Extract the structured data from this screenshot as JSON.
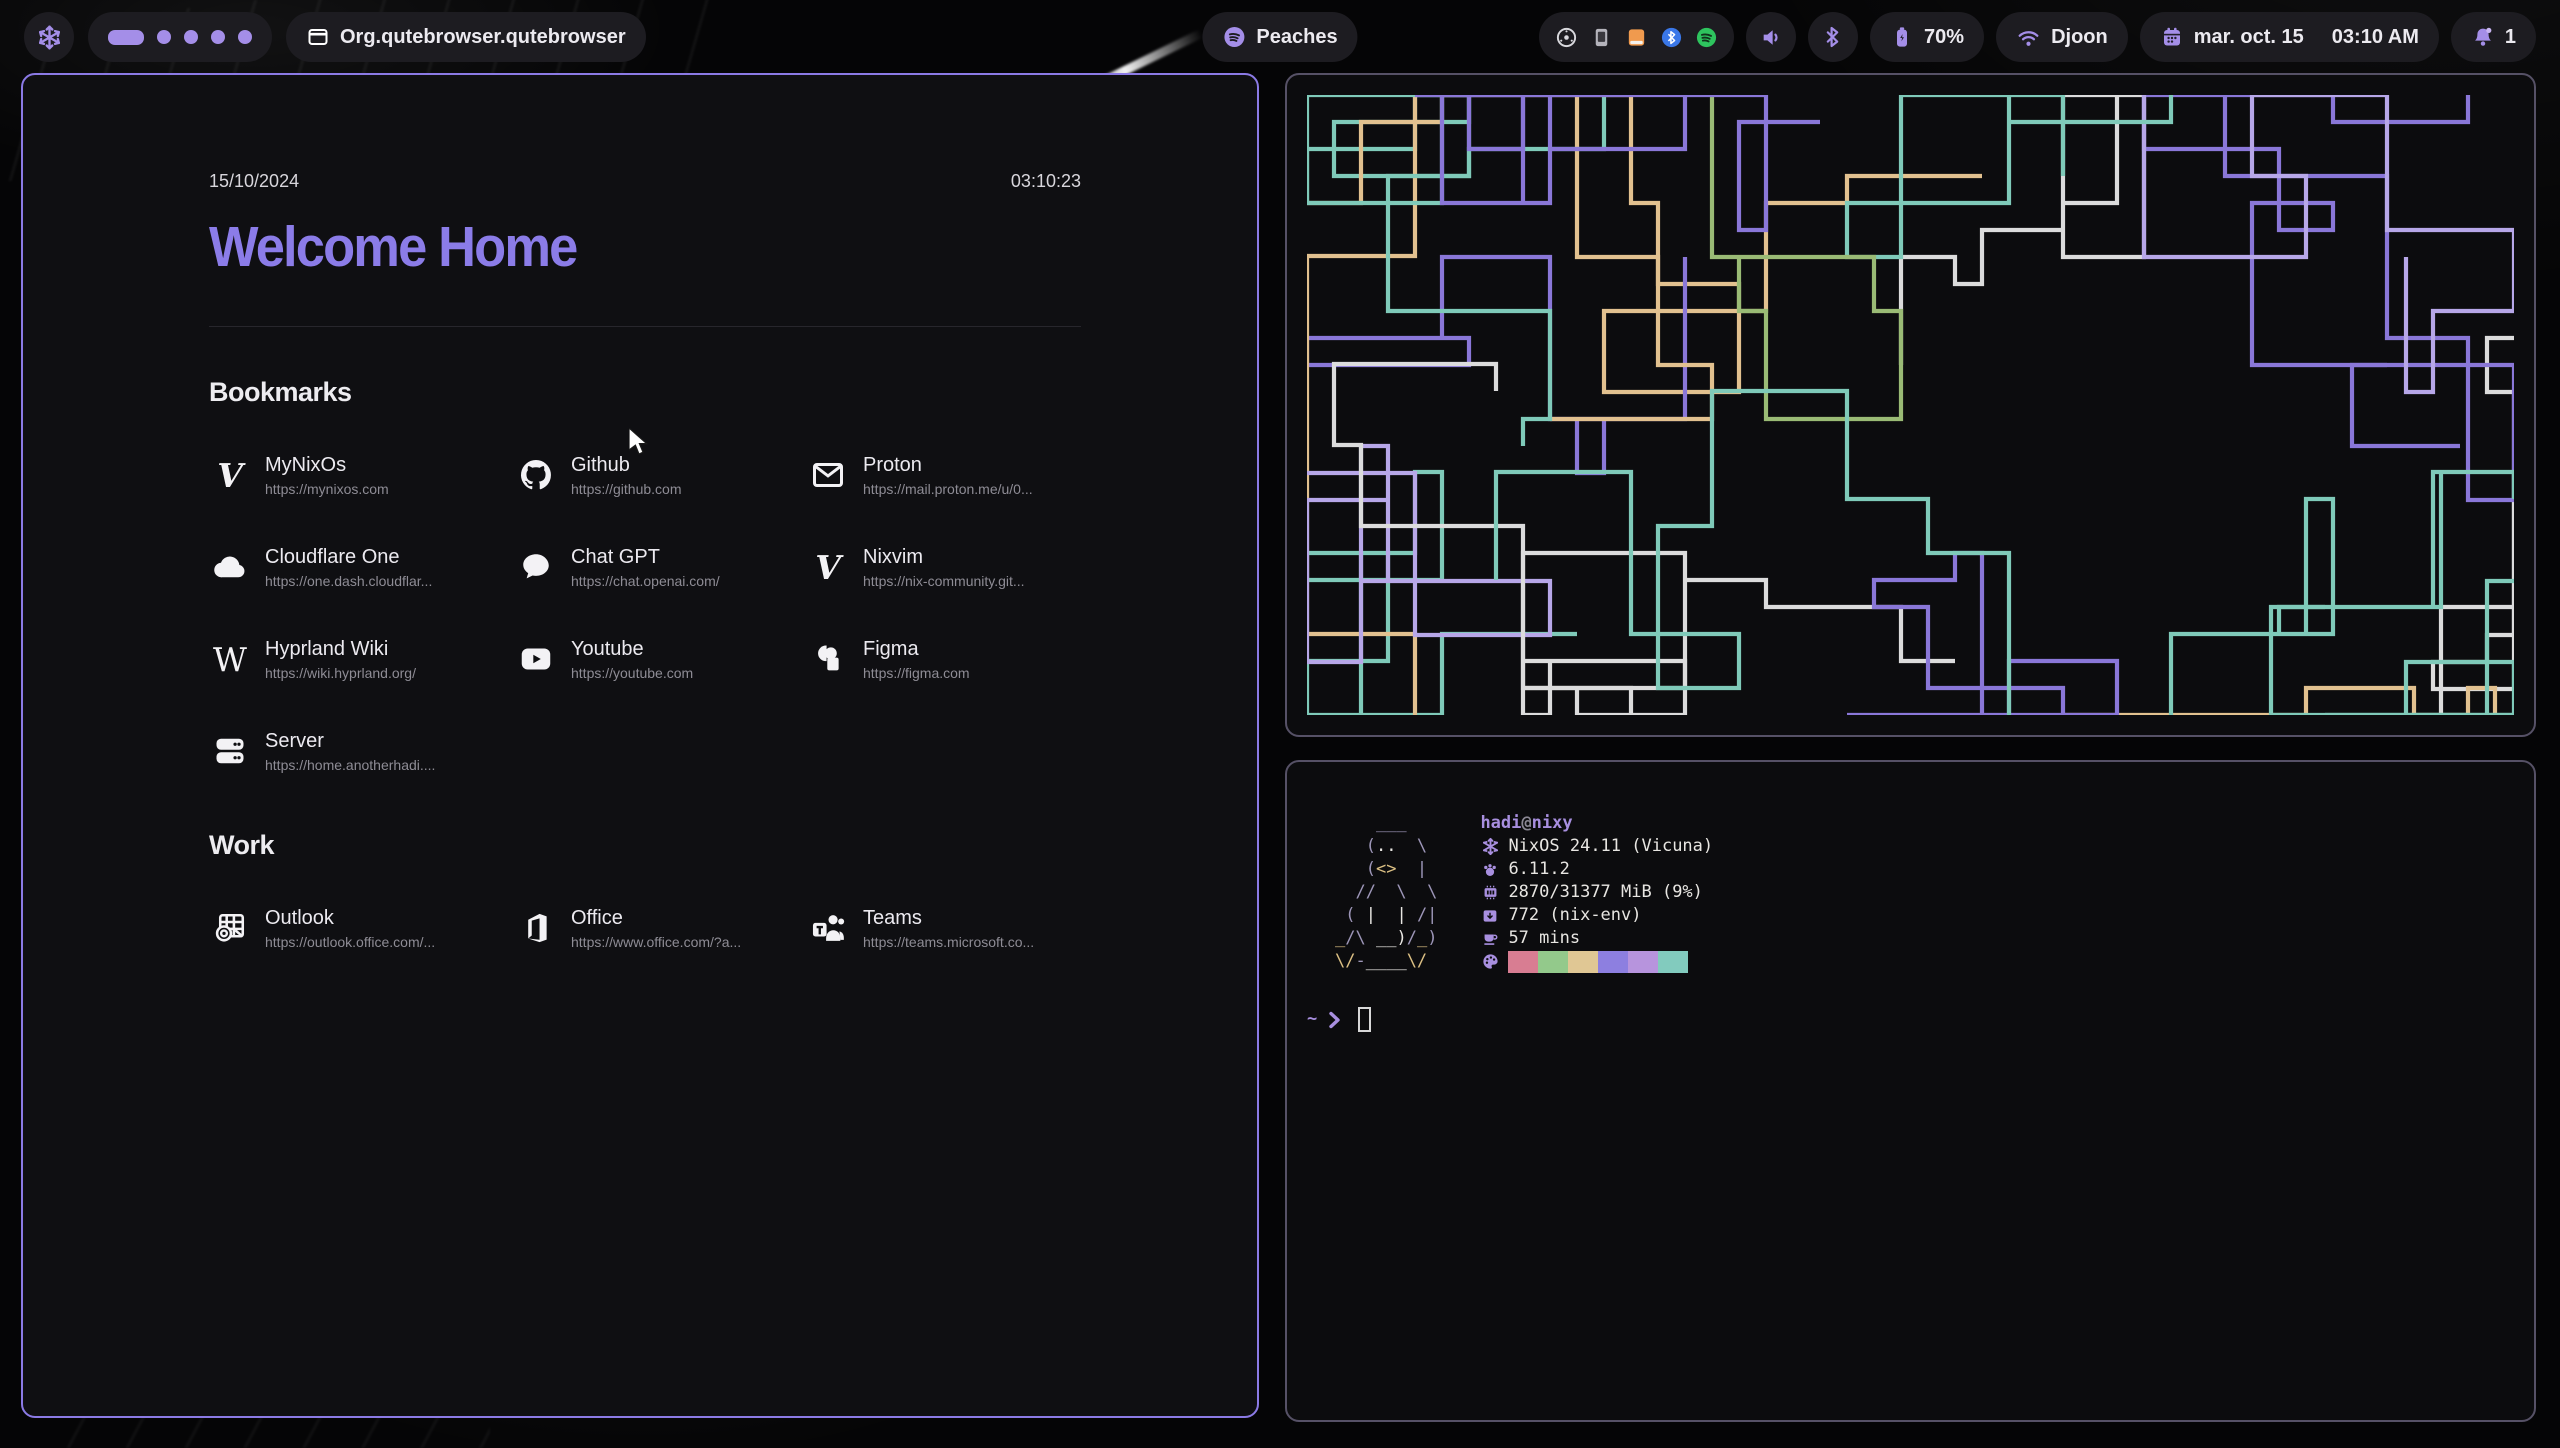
{
  "topbar": {
    "logo": "nix-snowflake-icon",
    "workspaces": {
      "total": 5,
      "active_index": 0
    },
    "window_title": "Org.qutebrowser.qutebrowser",
    "now_playing": "Peaches",
    "battery": "70%",
    "network": "Djoon",
    "date_label": "mar. oct. 15",
    "time_label": "03:10 AM",
    "notifications": "1"
  },
  "startpage": {
    "date": "15/10/2024",
    "time": "03:10:23",
    "title": "Welcome Home",
    "sections": [
      {
        "title": "Bookmarks",
        "items": [
          {
            "name": "MyNixOs",
            "url": "https://mynixos.com",
            "icon": "nix-snowflake-icon"
          },
          {
            "name": "Github",
            "url": "https://github.com",
            "icon": "github-icon"
          },
          {
            "name": "Proton",
            "url": "https://mail.proton.me/u/0...",
            "icon": "mail-icon"
          },
          {
            "name": "Cloudflare One",
            "url": "https://one.dash.cloudflar...",
            "icon": "cloud-icon"
          },
          {
            "name": "Chat GPT",
            "url": "https://chat.openai.com/",
            "icon": "chat-bubble-icon"
          },
          {
            "name": "Nixvim",
            "url": "https://nix-community.git...",
            "icon": "letter-v-icon"
          },
          {
            "name": "Hyprland Wiki",
            "url": "https://wiki.hyprland.org/",
            "icon": "wikipedia-icon"
          },
          {
            "name": "Youtube",
            "url": "https://youtube.com",
            "icon": "youtube-icon"
          },
          {
            "name": "Figma",
            "url": "https://figma.com",
            "icon": "figma-icon"
          },
          {
            "name": "Server",
            "url": "https://home.anotherhadi....",
            "icon": "server-icon"
          }
        ]
      },
      {
        "title": "Work",
        "items": [
          {
            "name": "Outlook",
            "url": "https://outlook.office.com/...",
            "icon": "outlook-icon"
          },
          {
            "name": "Office",
            "url": "https://www.office.com/?a...",
            "icon": "office-icon"
          },
          {
            "name": "Teams",
            "url": "https://teams.microsoft.co...",
            "icon": "teams-icon"
          }
        ]
      }
    ]
  },
  "fastfetch": {
    "user": "hadi",
    "at": "@",
    "host": "nixy",
    "rows": [
      {
        "icon": "nixos-icon",
        "text": "NixOS 24.11 (Vicuna)"
      },
      {
        "icon": "kernel-icon",
        "text": "6.11.2"
      },
      {
        "icon": "memory-icon",
        "text": "2870/31377 MiB (9%)"
      },
      {
        "icon": "packages-icon",
        "text": "772 (nix-env)"
      },
      {
        "icon": "uptime-icon",
        "text": "57 mins"
      }
    ],
    "palette": [
      "#d87d92",
      "#93c98b",
      "#e0c794",
      "#8d7fe0",
      "#b794dd",
      "#82cbbe"
    ],
    "prompt": {
      "path": "~",
      "symbol": "❯"
    },
    "ascii_art": [
      [
        {
          "t": "    ___",
          "c": "b"
        }
      ],
      [
        {
          "t": "   (",
          "c": "b"
        },
        {
          "t": "..",
          "c": "w"
        },
        {
          "t": "  \\",
          "c": "b"
        }
      ],
      [
        {
          "t": "   (",
          "c": "b"
        },
        {
          "t": "<>",
          "c": "y"
        },
        {
          "t": "  |",
          "c": "b"
        }
      ],
      [
        {
          "t": "  //  \\  \\",
          "c": "b"
        }
      ],
      [
        {
          "t": " ( ",
          "c": "b"
        },
        {
          "t": "|",
          "c": "w"
        },
        {
          "t": "  ",
          "c": "b"
        },
        {
          "t": "|",
          "c": "w"
        },
        {
          "t": " /|",
          "c": "b"
        }
      ],
      [
        {
          "t": "_",
          "c": "y"
        },
        {
          "t": "/\\ ",
          "c": "b"
        },
        {
          "t": "__)",
          "c": "w"
        },
        {
          "t": "/",
          "c": "b"
        },
        {
          "t": "_",
          "c": "y"
        },
        {
          "t": ")",
          "c": "b"
        }
      ],
      [
        {
          "t": "\\/",
          "c": "y"
        },
        {
          "t": "-",
          "c": "b"
        },
        {
          "t": "____",
          "c": "w"
        },
        {
          "t": "\\/",
          "c": "y"
        }
      ]
    ]
  },
  "pipes": {
    "colors": [
      "#7fcab9",
      "#7fcab9",
      "#7fcab9",
      "#8a77d8",
      "#8a77d8",
      "#9abb75",
      "#e2c18f",
      "#dcdcdc",
      "#b7a7e8"
    ]
  },
  "colors": {
    "accent_purple": "#a48ee8",
    "title_purple": "#8b7ce8",
    "active_border": "#8b7ae5",
    "inactive_border": "#565166",
    "pill_background": "#1d1c21",
    "tray_orange": "#f09a4e",
    "tray_blue": "#3a77e8",
    "tray_green": "#2ec45e"
  }
}
